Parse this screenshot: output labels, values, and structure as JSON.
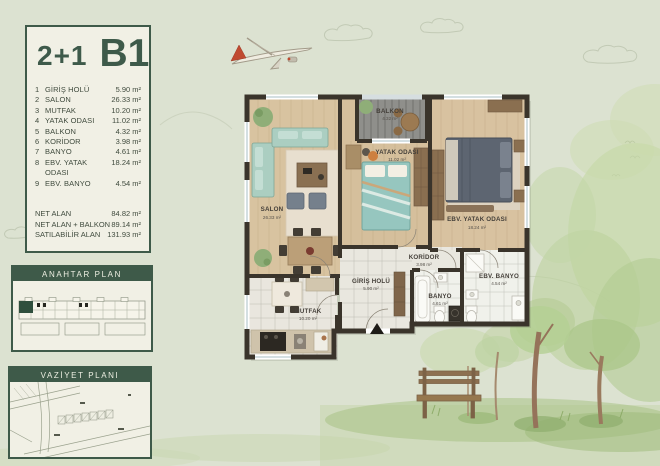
{
  "page": {
    "title_type": "2+1",
    "title_block": "B1"
  },
  "info_panel": {
    "rooms": [
      {
        "no": "1",
        "name": "GİRİŞ HOLÜ",
        "area": "5.90 m²"
      },
      {
        "no": "2",
        "name": "SALON",
        "area": "26.33 m²"
      },
      {
        "no": "3",
        "name": "MUTFAK",
        "area": "10.20 m²"
      },
      {
        "no": "4",
        "name": "YATAK ODASI",
        "area": "11.02 m²"
      },
      {
        "no": "5",
        "name": "BALKON",
        "area": "4.32 m²"
      },
      {
        "no": "6",
        "name": "KORİDOR",
        "area": "3.98 m²"
      },
      {
        "no": "7",
        "name": "BANYO",
        "area": "4.61 m²"
      },
      {
        "no": "8",
        "name": "EBV. YATAK ODASI",
        "area": "18.24 m²"
      },
      {
        "no": "9",
        "name": "EBV. BANYO",
        "area": "4.54 m²"
      }
    ],
    "totals": [
      {
        "name": "NET ALAN",
        "value": "84.82 m²"
      },
      {
        "name": "NET ALAN + BALKON",
        "value": "89.14 m²"
      },
      {
        "name": "SATILABİLİR ALAN",
        "value": "131.93 m²"
      }
    ]
  },
  "key_plan": {
    "title": "ANAHTAR PLAN"
  },
  "site_plan": {
    "title": "VAZİYET PLANI"
  },
  "floor_plan": {
    "labels": [
      {
        "name": "SALON",
        "area": "26.33 m²"
      },
      {
        "name": "BALKON",
        "area": "4.32 m²"
      },
      {
        "name": "YATAK ODASI",
        "area": "11.02 m²"
      },
      {
        "name": "EBV. YATAK ODASI",
        "area": "18.24 m²"
      },
      {
        "name": "KORİDOR",
        "area": "3.98 m²"
      },
      {
        "name": "GİRİŞ HOLÜ",
        "area": "5.90 m²"
      },
      {
        "name": "BANYO",
        "area": "4.61 m²"
      },
      {
        "name": "EBV. BANYO",
        "area": "4.54 m²"
      },
      {
        "name": "MUTFAK",
        "area": "10.20 m²"
      }
    ]
  },
  "colors": {
    "background": "#dce2d1",
    "panel": "#f1f0e5",
    "green": "#3e5a49",
    "wall": "#3a342b",
    "wood": "#d8c3a0",
    "tile": "#e9e6de",
    "deck": "#8f8f8b",
    "red_accent": "#c04a30"
  }
}
